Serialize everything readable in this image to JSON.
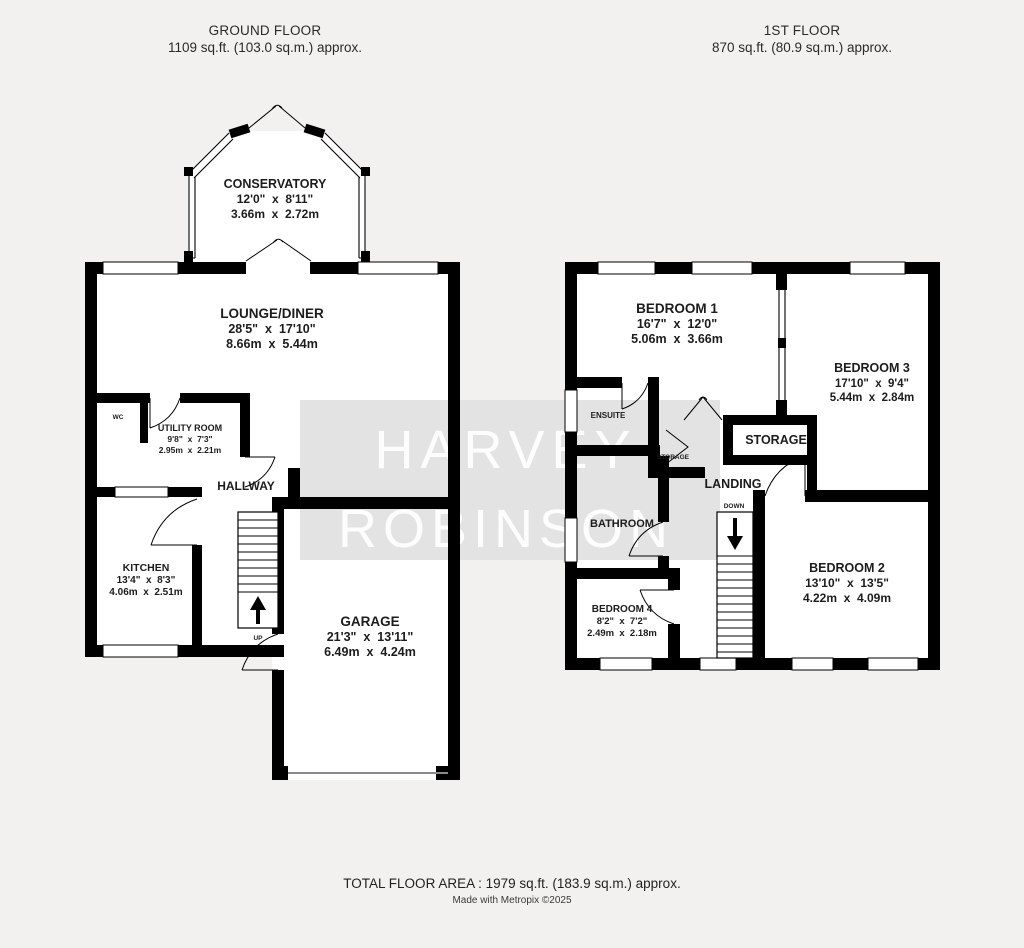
{
  "colors": {
    "background": "#f2f1ef",
    "wall": "#000000",
    "watermark_box": "#e3e3e3",
    "watermark_text": "#ffffff",
    "label_ink": "#1c1c1c",
    "garage_door_line": "#8a8a8a"
  },
  "headers": {
    "ground": {
      "title": "GROUND FLOOR",
      "area": "1109 sq.ft. (103.0 sq.m.) approx."
    },
    "first": {
      "title": "1ST FLOOR",
      "area": "870 sq.ft. (80.9 sq.m.) approx."
    }
  },
  "watermark": {
    "line1": "HARVEY",
    "line2": "ROBINSON"
  },
  "footer": {
    "total": "TOTAL FLOOR AREA : 1979 sq.ft. (183.9 sq.m.) approx.",
    "credit": "Made with Metropix ©2025"
  },
  "rooms": {
    "conservatory": {
      "name": "CONSERVATORY",
      "imperial": "12'0\"  x  8'11\"",
      "metric": "3.66m  x  2.72m"
    },
    "lounge_diner": {
      "name": "LOUNGE/DINER",
      "imperial": "28'5\"  x  17'10\"",
      "metric": "8.66m  x  5.44m"
    },
    "utility": {
      "name": "UTILITY ROOM",
      "imperial": "9'8\"  x  7'3\"",
      "metric": "2.95m  x  2.21m"
    },
    "wc": {
      "name": "WC"
    },
    "hallway": {
      "name": "HALLWAY"
    },
    "kitchen": {
      "name": "KITCHEN",
      "imperial": "13'4\"  x  8'3\"",
      "metric": "4.06m  x  2.51m"
    },
    "garage": {
      "name": "GARAGE",
      "imperial": "21'3\"  x  13'11\"",
      "metric": "6.49m  x  4.24m"
    },
    "bedroom1": {
      "name": "BEDROOM 1",
      "imperial": "16'7\"  x  12'0\"",
      "metric": "5.06m  x  3.66m"
    },
    "bedroom2": {
      "name": "BEDROOM 2",
      "imperial": "13'10\"  x  13'5\"",
      "metric": "4.22m  x  4.09m"
    },
    "bedroom3": {
      "name": "BEDROOM 3",
      "imperial": "17'10\"  x  9'4\"",
      "metric": "5.44m  x  2.84m"
    },
    "bedroom4": {
      "name": "BEDROOM 4",
      "imperial": "8'2\"  x  7'2\"",
      "metric": "2.49m  x  2.18m"
    },
    "ensuite": {
      "name": "ENSUITE"
    },
    "bathroom": {
      "name": "BATHROOM"
    },
    "landing": {
      "name": "LANDING"
    },
    "storage": {
      "name": "STORAGE"
    },
    "storage_small": {
      "name": "STORAGE"
    }
  },
  "stairs": {
    "up": "UP",
    "down": "DOWN"
  }
}
